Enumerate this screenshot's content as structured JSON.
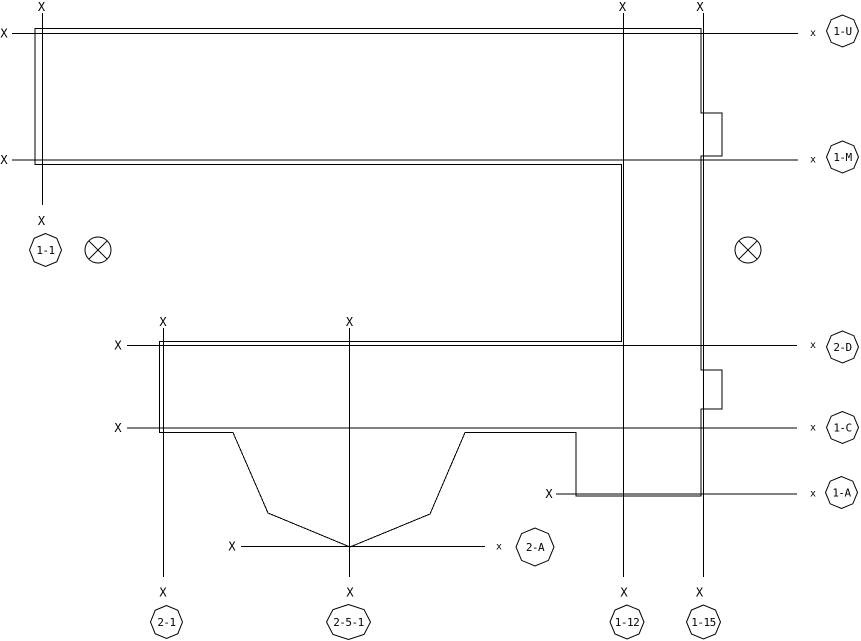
{
  "drawing": {
    "canvas": {
      "width": 861,
      "height": 641,
      "background": "#ffffff",
      "line_color": "#000000"
    },
    "outline": {
      "name": "building-outline",
      "closed": true,
      "points": [
        [
          35,
          28.5
        ],
        [
          701,
          28.5
        ],
        [
          701,
          113
        ],
        [
          722,
          113
        ],
        [
          722,
          156
        ],
        [
          701,
          156
        ],
        [
          701,
          370
        ],
        [
          722,
          370
        ],
        [
          722,
          409
        ],
        [
          701,
          409
        ],
        [
          701,
          496
        ],
        [
          576,
          496
        ],
        [
          576,
          432.5
        ],
        [
          465,
          432.5
        ],
        [
          430,
          514
        ],
        [
          350,
          547
        ],
        [
          268,
          513
        ],
        [
          233,
          432.5
        ],
        [
          159.5,
          432.5
        ],
        [
          159.5,
          341.5
        ],
        [
          621.5,
          341.5
        ],
        [
          621.5,
          164.5
        ],
        [
          35,
          164.5
        ]
      ]
    },
    "grid_lines": [
      {
        "id": "1-U",
        "orientation": "h",
        "pos": 33.5,
        "start": 12,
        "end": 798,
        "markers": [
          {
            "x": 4,
            "y": 33.5,
            "glyph": "X"
          },
          {
            "x": 813,
            "y": 33.5,
            "glyph": "x"
          }
        ],
        "bubble": {
          "cx": 842.5,
          "cy": 31,
          "rx": 16,
          "ry": 16,
          "label": "1-U"
        }
      },
      {
        "id": "1-M",
        "orientation": "h",
        "pos": 160,
        "start": 12,
        "end": 798,
        "markers": [
          {
            "x": 4,
            "y": 160,
            "glyph": "X"
          },
          {
            "x": 813,
            "y": 160,
            "glyph": "x"
          }
        ],
        "bubble": {
          "cx": 842.5,
          "cy": 157,
          "rx": 16,
          "ry": 16,
          "label": "1-M"
        }
      },
      {
        "id": "2-D",
        "orientation": "h",
        "pos": 345.5,
        "start": 127,
        "end": 797,
        "markers": [
          {
            "x": 118,
            "y": 345.5,
            "glyph": "X"
          },
          {
            "x": 813,
            "y": 345.5,
            "glyph": "x"
          }
        ],
        "bubble": {
          "cx": 842.5,
          "cy": 347,
          "rx": 16,
          "ry": 16,
          "label": "2-D"
        }
      },
      {
        "id": "1-C",
        "orientation": "h",
        "pos": 428,
        "start": 127,
        "end": 797,
        "markers": [
          {
            "x": 118,
            "y": 428,
            "glyph": "X"
          },
          {
            "x": 813,
            "y": 428,
            "glyph": "x"
          }
        ],
        "bubble": {
          "cx": 842.5,
          "cy": 427.5,
          "rx": 16,
          "ry": 16,
          "label": "1-C"
        }
      },
      {
        "id": "1-A",
        "orientation": "h",
        "pos": 494,
        "start": 556,
        "end": 797,
        "markers": [
          {
            "x": 549,
            "y": 494,
            "glyph": "X"
          },
          {
            "x": 813,
            "y": 494,
            "glyph": "x"
          }
        ],
        "bubble": {
          "cx": 841.5,
          "cy": 492.5,
          "rx": 16,
          "ry": 16,
          "label": "1-A"
        }
      },
      {
        "id": "2-A",
        "orientation": "h",
        "pos": 546.5,
        "start": 241,
        "end": 485,
        "markers": [
          {
            "x": 232,
            "y": 546.5,
            "glyph": "X"
          },
          {
            "x": 499,
            "y": 547,
            "glyph": "x"
          }
        ],
        "bubble": {
          "cx": 535,
          "cy": 547,
          "rx": 19,
          "ry": 19,
          "label": "2-A"
        }
      },
      {
        "id": "1-1",
        "orientation": "v",
        "pos": 42.5,
        "start": 13,
        "end": 205,
        "markers": [
          {
            "x": 41.5,
            "y": 7,
            "glyph": "X"
          },
          {
            "x": 41.5,
            "y": 221,
            "glyph": "X"
          }
        ],
        "bubble": {
          "cx": 45.5,
          "cy": 250,
          "rx": 16,
          "ry": 16.5,
          "label": "1-1"
        }
      },
      {
        "id": "2-1",
        "orientation": "v",
        "pos": 163.5,
        "start": 328,
        "end": 577,
        "markers": [
          {
            "x": 163,
            "y": 322,
            "glyph": "X"
          },
          {
            "x": 163,
            "y": 592.5,
            "glyph": "X"
          }
        ],
        "bubble": {
          "cx": 166.5,
          "cy": 622,
          "rx": 16,
          "ry": 16.5,
          "label": "2-1"
        }
      },
      {
        "id": "2-5-1",
        "orientation": "v",
        "pos": 349.5,
        "start": 328,
        "end": 577,
        "markers": [
          {
            "x": 349.5,
            "y": 322,
            "glyph": "X"
          },
          {
            "x": 350,
            "y": 592.5,
            "glyph": "X"
          }
        ],
        "bubble": {
          "cx": 348.5,
          "cy": 622,
          "rx": 22,
          "ry": 17.5,
          "label": "2-5-1"
        }
      },
      {
        "id": "1-12",
        "orientation": "v",
        "pos": 623.5,
        "start": 13,
        "end": 577,
        "markers": [
          {
            "x": 622.5,
            "y": 7,
            "glyph": "X"
          },
          {
            "x": 624,
            "y": 592.5,
            "glyph": "X"
          }
        ],
        "bubble": {
          "cx": 627,
          "cy": 622,
          "rx": 17,
          "ry": 17,
          "label": "1-12"
        }
      },
      {
        "id": "1-15",
        "orientation": "v",
        "pos": 703.5,
        "start": 13,
        "end": 577,
        "markers": [
          {
            "x": 700,
            "y": 7,
            "glyph": "X"
          },
          {
            "x": 699.5,
            "y": 592.5,
            "glyph": "X"
          }
        ],
        "bubble": {
          "cx": 703.5,
          "cy": 622,
          "rx": 17,
          "ry": 17,
          "label": "1-15"
        }
      }
    ],
    "symbols": [
      {
        "type": "circled-x",
        "cx": 98,
        "cy": 250,
        "r": 13
      },
      {
        "type": "circled-x",
        "cx": 748,
        "cy": 250,
        "r": 13
      }
    ]
  }
}
